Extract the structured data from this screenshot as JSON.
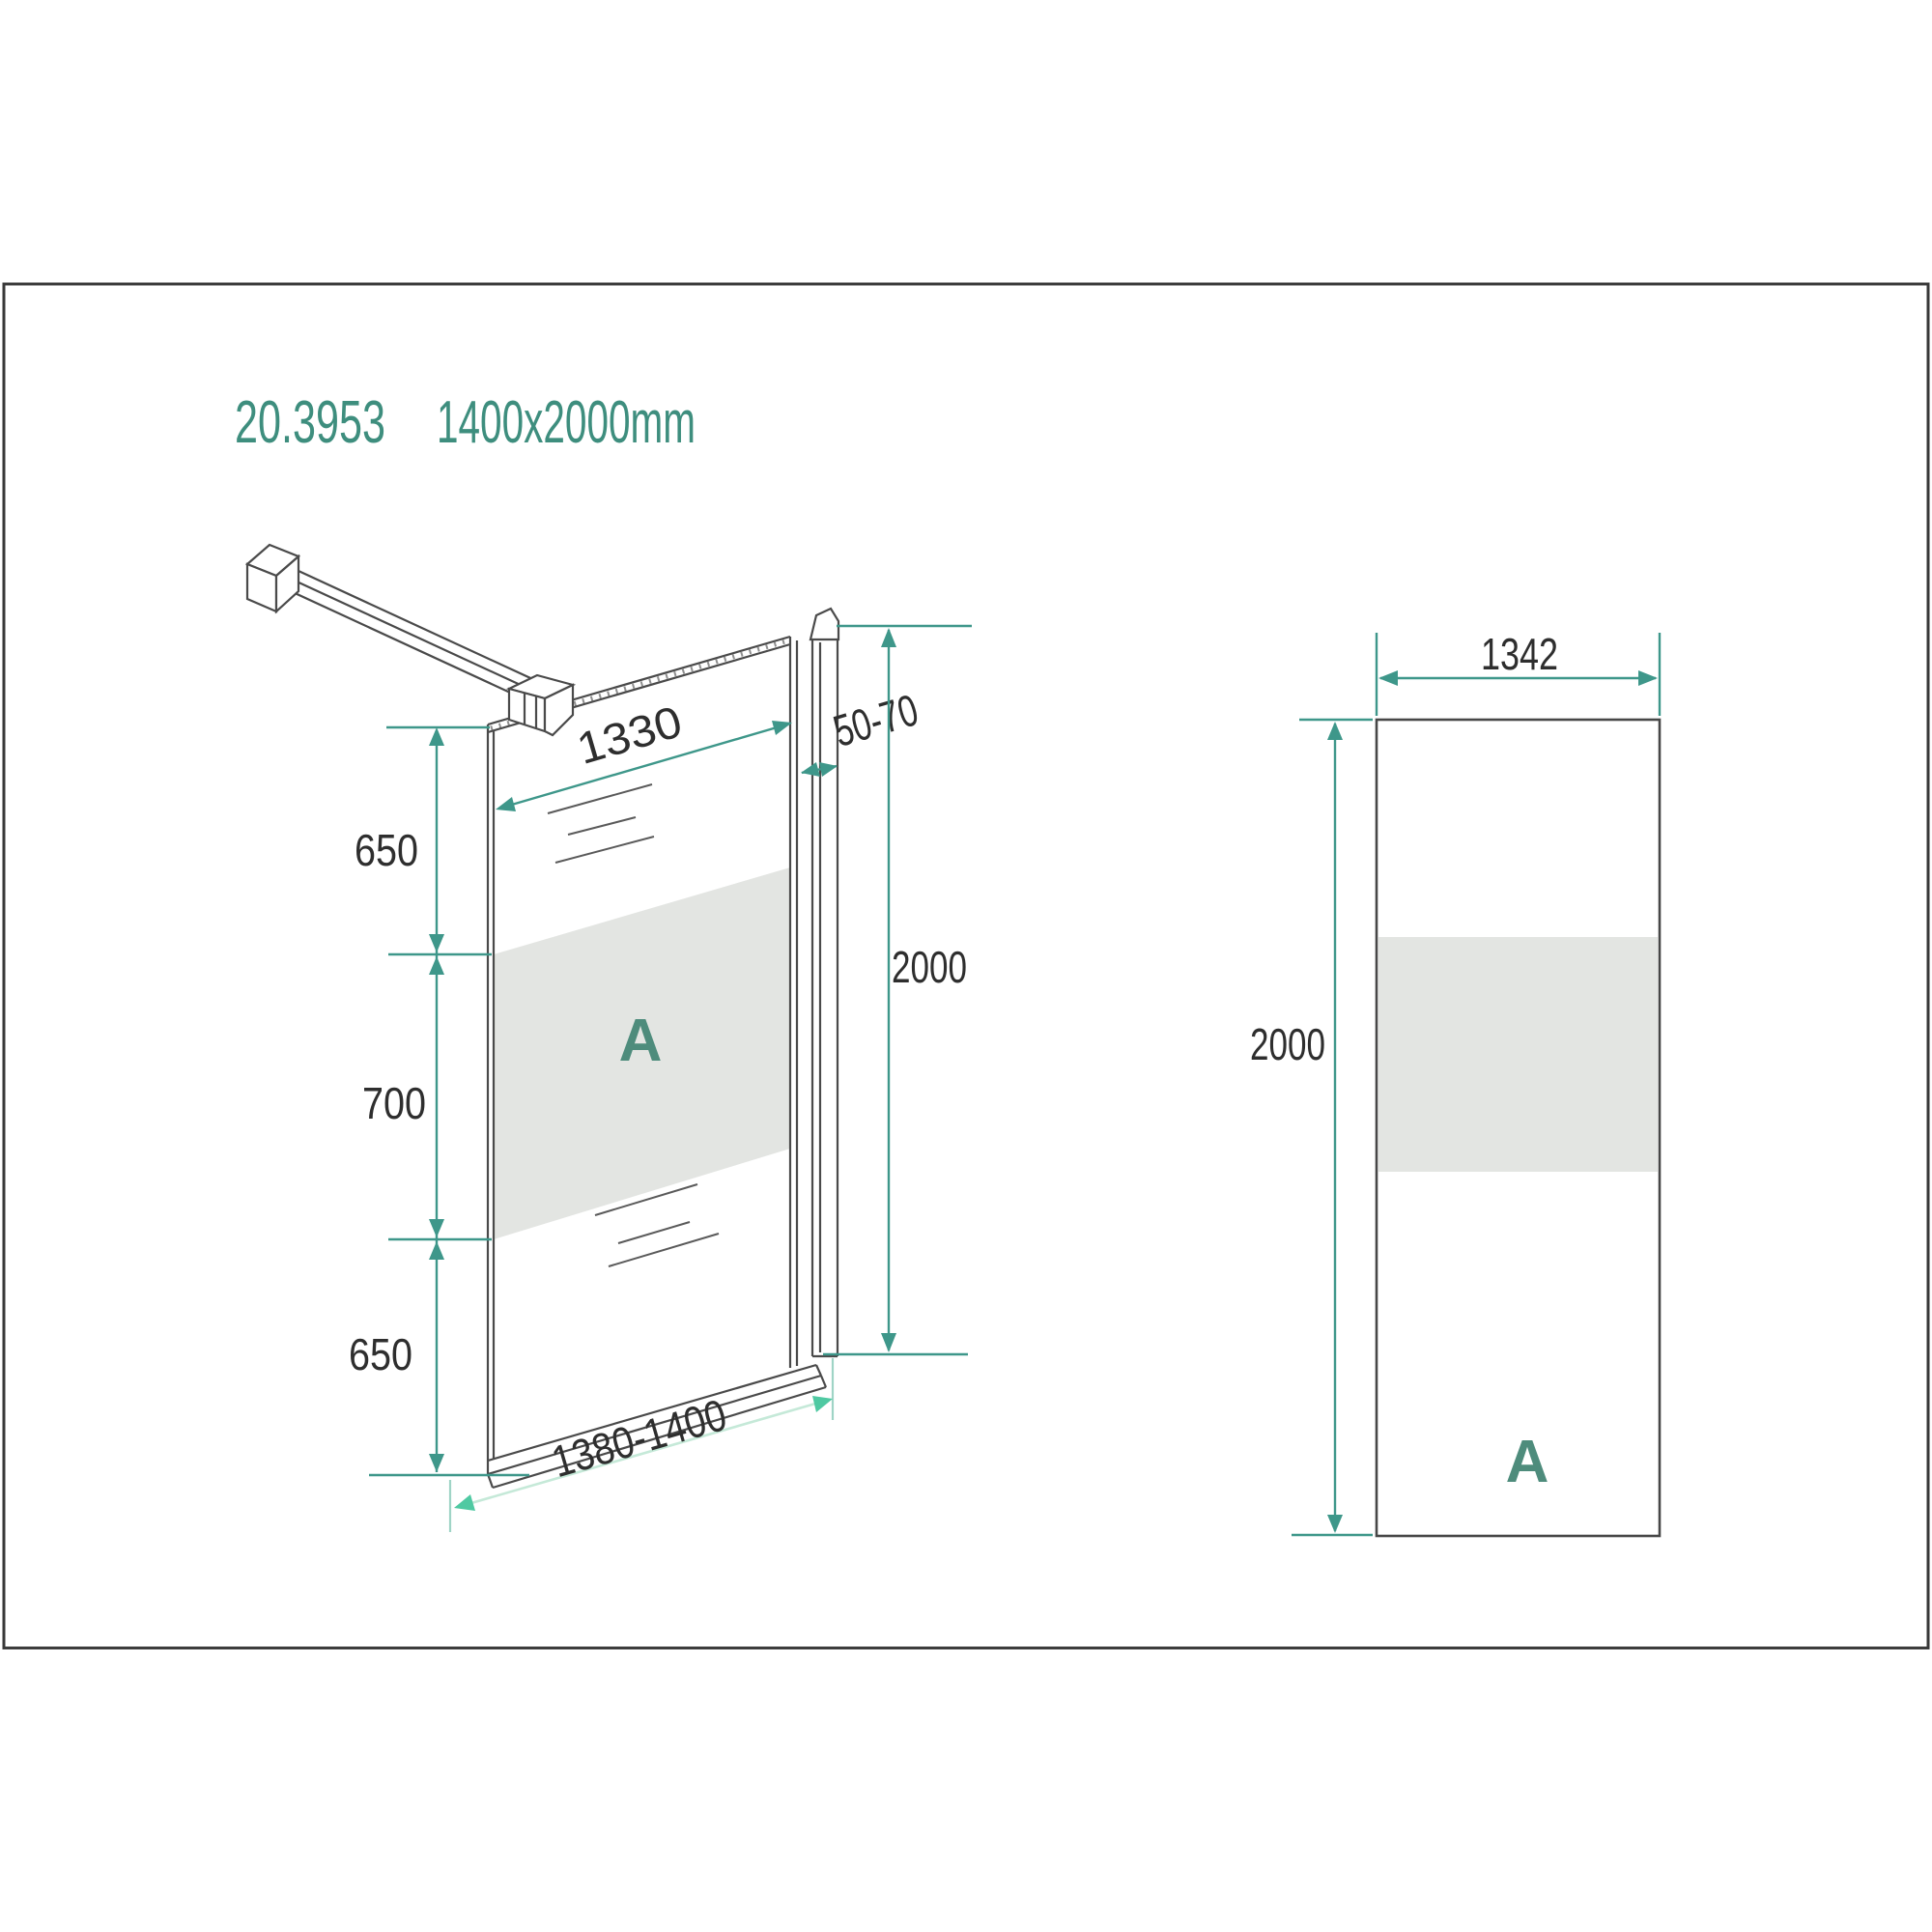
{
  "title": {
    "model": "20.3953",
    "size": "1400x2000mm"
  },
  "colors": {
    "accent_teal_dim": "#3E978A",
    "title_teal": "#3E8E7E",
    "panel_label_teal": "#4E8C7C",
    "bright_green_arrow": "#4FC9A2",
    "pale_green_dim_line": "#C5E9D8",
    "frosted_band_gray": "#E3E5E2",
    "drawing_line_gray": "#4A4A4A",
    "dim_text": "#2E2E2E",
    "frame_border": "#383838"
  },
  "perspective_view": {
    "description": "walk-in shower glass screen with support bar, perspective view",
    "panel_label": "A",
    "dims": {
      "glass_width_top": "1330",
      "wall_gap": "50-70",
      "height": "2000",
      "segment_top": "650",
      "segment_middle": "700",
      "segment_bottom": "650",
      "overall_width": "1380-1400"
    }
  },
  "front_view": {
    "description": "glass panel front elevation",
    "panel_label": "A",
    "dims": {
      "width": "1342",
      "height": "2000"
    }
  }
}
